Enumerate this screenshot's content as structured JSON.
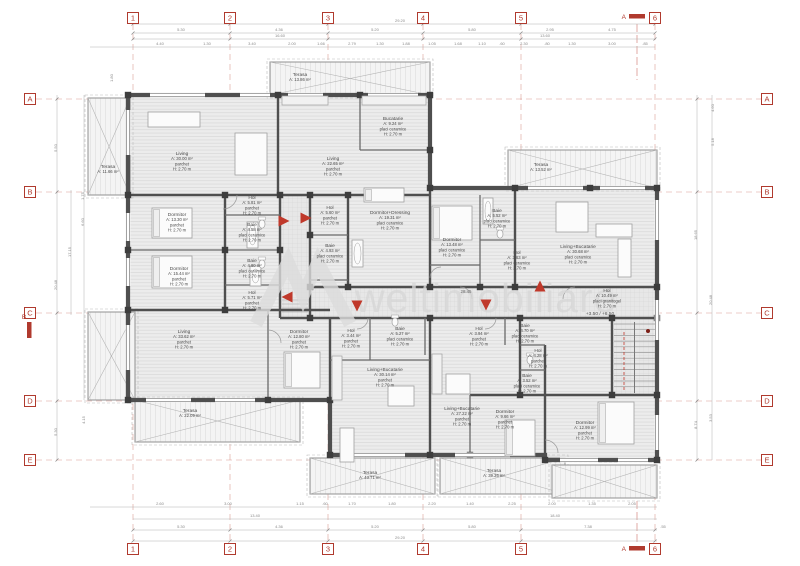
{
  "watermark": {
    "text": "weltimobiliare"
  },
  "colors": {
    "marker_red": "#b03a2e",
    "grid_red": "#c96a5e",
    "wall": "#4f4f4f",
    "partition": "#6a6a6a",
    "dim_text": "#8a8a8a",
    "label_text": "#4a4a4a",
    "watermark_gray": "#d7d7d7",
    "arrow_red": "#c0392b"
  },
  "grid": {
    "columns": [
      {
        "label": "1",
        "x": 133
      },
      {
        "label": "2",
        "x": 230
      },
      {
        "label": "3",
        "x": 328
      },
      {
        "label": "4",
        "x": 423
      },
      {
        "label": "5",
        "x": 521
      },
      {
        "label": "6",
        "x": 655
      }
    ],
    "rows": [
      {
        "label": "A",
        "y": 99
      },
      {
        "label": "B",
        "y": 192
      },
      {
        "label": "C",
        "y": 313
      },
      {
        "label": "D",
        "y": 401
      },
      {
        "label": "E",
        "y": 460
      }
    ],
    "sections": {
      "top_label": "A",
      "bottom_label": "A",
      "left_label": "B"
    }
  },
  "corridor": {
    "length_label": "28.45",
    "level_label": "+3.50 / +6.50"
  },
  "rooms": [
    {
      "kind": "room",
      "name": "Living",
      "area": "A: 30.00 m²",
      "finish": "parchet",
      "height": "H: 2.70 m",
      "x": 182,
      "y": 155
    },
    {
      "kind": "room",
      "name": "Living",
      "area": "A: 22.65 m²",
      "finish": "parchet",
      "height": "H: 2.70 m",
      "x": 333,
      "y": 160
    },
    {
      "kind": "room",
      "name": "Bucatarie",
      "area": "A: 9.24 m²",
      "finish": "placi ceramice",
      "height": "H: 2.70 m",
      "x": 393,
      "y": 120
    },
    {
      "kind": "terrace",
      "name": "Terasa",
      "area": "A: 13.86 m²",
      "x": 300,
      "y": 76
    },
    {
      "kind": "terrace",
      "name": "Terasa",
      "area": "A: 11.66 m²",
      "x": 108,
      "y": 168
    },
    {
      "kind": "terrace",
      "name": "Terasa",
      "area": "A: 13.52 m²",
      "x": 541,
      "y": 166
    },
    {
      "kind": "room",
      "name": "Living+Bucatarie",
      "area": "A: 30.68 m²",
      "finish": "placi ceramice",
      "height": "H: 2.70 m",
      "x": 578,
      "y": 248
    },
    {
      "kind": "room",
      "name": "Dormitor",
      "area": "A: 13.48 m²",
      "finish": "placi ceramice",
      "height": "H: 2.70 m",
      "x": 452,
      "y": 241
    },
    {
      "kind": "room",
      "name": "Baie",
      "area": "A: 5.52 m²",
      "finish": "placi ceramice",
      "height": "H: 2.70 m",
      "x": 497,
      "y": 212
    },
    {
      "kind": "room",
      "name": "Hol",
      "area": "A: 3.63 m²",
      "finish": "placi ceramice",
      "height": "H: 2.70 m",
      "x": 517,
      "y": 254
    },
    {
      "kind": "room",
      "name": "Dormitor+Dressing",
      "area": "A: 19.31 m²",
      "finish": "placi ceramice",
      "height": "H: 2.70 m",
      "x": 390,
      "y": 214
    },
    {
      "kind": "room",
      "name": "Hol",
      "area": "A: 5.60 m²",
      "finish": "parchet",
      "height": "H: 2.70 m",
      "x": 330,
      "y": 209
    },
    {
      "kind": "room",
      "name": "Baie",
      "area": "A: 4.93 m²",
      "finish": "placi ceramice",
      "height": "H: 2.70 m",
      "x": 330,
      "y": 247
    },
    {
      "kind": "room",
      "name": "Hol",
      "area": "A: 5.81 m²",
      "finish": "parchet",
      "height": "H: 2.70 m",
      "x": 252,
      "y": 199
    },
    {
      "kind": "room",
      "name": "Baie",
      "area": "A: 4.58 m²",
      "finish": "placi ceramice",
      "height": "H: 2.70 m",
      "x": 252,
      "y": 226
    },
    {
      "kind": "room",
      "name": "Baie",
      "area": "A: 4.80 m²",
      "finish": "placi ceramice",
      "height": "H: 2.70 m",
      "x": 252,
      "y": 262
    },
    {
      "kind": "room",
      "name": "Hol",
      "area": "A: 5.71 m²",
      "finish": "parchet",
      "height": "H: 2.70 m",
      "x": 252,
      "y": 294
    },
    {
      "kind": "room",
      "name": "Dormitor",
      "area": "A: 13.30 m²",
      "finish": "parchet",
      "height": "H: 2.70 m",
      "x": 177,
      "y": 216
    },
    {
      "kind": "room",
      "name": "Dormitor",
      "area": "A: 15.44 m²",
      "finish": "parchet",
      "height": "H: 2.70 m",
      "x": 179,
      "y": 270
    },
    {
      "kind": "room",
      "name": "Hol",
      "area": "A: 10.49 m²",
      "finish": "placi granitogel",
      "height": "H: 2.70 m",
      "x": 607,
      "y": 292
    },
    {
      "kind": "room",
      "name": "Living",
      "area": "A: 33.62 m²",
      "finish": "parchet",
      "height": "H: 2.70 m",
      "x": 184,
      "y": 333
    },
    {
      "kind": "room",
      "name": "Dormitor",
      "area": "A: 12.80 m²",
      "finish": "parchet",
      "height": "H: 2.70 m",
      "x": 299,
      "y": 333
    },
    {
      "kind": "terrace",
      "name": "Terasa",
      "area": "A: 22.09 m²",
      "x": 190,
      "y": 412
    },
    {
      "kind": "room",
      "name": "Hol",
      "area": "A: 3.44 m²",
      "finish": "parchet",
      "height": "H: 2.70 m",
      "x": 351,
      "y": 332
    },
    {
      "kind": "room",
      "name": "Baie",
      "area": "A: 5.27 m²",
      "finish": "placi ceramice",
      "height": "H: 2.70 m",
      "x": 400,
      "y": 330
    },
    {
      "kind": "room",
      "name": "Living+Bucatarie",
      "area": "A: 30.14 m²",
      "finish": "parchet",
      "height": "H: 2.70 m",
      "x": 385,
      "y": 371
    },
    {
      "kind": "room",
      "name": "Hol",
      "area": "A: 3.94 m²",
      "finish": "parchet",
      "height": "H: 2.70 m",
      "x": 479,
      "y": 330
    },
    {
      "kind": "room",
      "name": "Living+Bucatarie",
      "area": "A: 27.22 m²",
      "finish": "parchet",
      "height": "H: 2.70 m",
      "x": 462,
      "y": 410
    },
    {
      "kind": "room",
      "name": "Baie",
      "area": "A: 4.70 m²",
      "finish": "placi ceramice",
      "height": "H: 2.70 m",
      "x": 525,
      "y": 327
    },
    {
      "kind": "room",
      "name": "Hol",
      "area": "A: 4.28 m²",
      "finish": "parchet",
      "height": "H: 2.70 m",
      "x": 538,
      "y": 352
    },
    {
      "kind": "room",
      "name": "Baie",
      "area": "A: 3.52 m²",
      "finish": "placi ceramice",
      "height": "H: 2.70 m",
      "x": 527,
      "y": 377
    },
    {
      "kind": "room",
      "name": "Dormitor",
      "area": "A: 9.66 m²",
      "finish": "parchet",
      "height": "H: 2.70 m",
      "x": 505,
      "y": 413
    },
    {
      "kind": "room",
      "name": "Dormitor",
      "area": "A: 12.99 m²",
      "finish": "parchet",
      "height": "H: 2.70 m",
      "x": 585,
      "y": 424
    },
    {
      "kind": "terrace",
      "name": "Terasa",
      "area": "A: 43.71 m²",
      "x": 370,
      "y": 474
    },
    {
      "kind": "terrace",
      "name": "Terasa",
      "area": "A: 39.26 m²",
      "x": 494,
      "y": 472
    }
  ],
  "dimensions": {
    "top_overall": {
      "t": "29.20",
      "x": 400,
      "y": 22
    },
    "top_segments": [
      {
        "t": "5.30",
        "x": 181,
        "y": 31
      },
      {
        "t": "4.36",
        "x": 279,
        "y": 31
      },
      {
        "t": "5.20",
        "x": 375,
        "y": 31
      },
      {
        "t": "5.80",
        "x": 472,
        "y": 31
      },
      {
        "t": "2.95",
        "x": 550,
        "y": 31
      },
      {
        "t": "4.75",
        "x": 612,
        "y": 31
      }
    ],
    "top_subtotals": [
      {
        "t": "16.60",
        "x": 280,
        "y": 37
      },
      {
        "t": "13.60",
        "x": 545,
        "y": 37
      }
    ],
    "top_details": [
      {
        "t": "4.40",
        "x": 160
      },
      {
        "t": "1.30",
        "x": 207
      },
      {
        "t": "3.40",
        "x": 252
      },
      {
        "t": "2.00",
        "x": 292
      },
      {
        "t": "1.66",
        "x": 321
      },
      {
        "t": "2.79",
        "x": 352
      },
      {
        "t": "1.30",
        "x": 380
      },
      {
        "t": "1.88",
        "x": 406
      },
      {
        "t": "1.05",
        "x": 432
      },
      {
        "t": "1.68",
        "x": 458
      },
      {
        "t": "1.10",
        "x": 482
      },
      {
        "t": ".60",
        "x": 502
      },
      {
        "t": "2.30",
        "x": 524
      },
      {
        "t": ".80",
        "x": 547
      },
      {
        "t": "1.30",
        "x": 572
      },
      {
        "t": "3.00",
        "x": 612
      },
      {
        "t": ".85",
        "x": 645
      }
    ],
    "bottom_details": [
      {
        "t": "2.60",
        "x": 160
      },
      {
        "t": "3.00",
        "x": 228
      },
      {
        "t": "1.15",
        "x": 300
      },
      {
        "t": ".60",
        "x": 325
      },
      {
        "t": "1.70",
        "x": 352
      },
      {
        "t": "1.80",
        "x": 392
      },
      {
        "t": "2.20",
        "x": 432
      },
      {
        "t": "1.40",
        "x": 470
      },
      {
        "t": "2.25",
        "x": 512
      },
      {
        "t": "2.00",
        "x": 552
      },
      {
        "t": "1.35",
        "x": 592
      },
      {
        "t": "2.05",
        "x": 632
      }
    ],
    "bottom_subtotals": [
      {
        "t": "13.40",
        "x": 255,
        "y": 517
      },
      {
        "t": "18.40",
        "x": 555,
        "y": 517
      }
    ],
    "bottom_segments": [
      {
        "t": "5.30",
        "x": 181,
        "y": 528
      },
      {
        "t": "4.36",
        "x": 279,
        "y": 528
      },
      {
        "t": "5.20",
        "x": 375,
        "y": 528
      },
      {
        "t": "5.80",
        "x": 472,
        "y": 528
      },
      {
        "t": "7.38",
        "x": 588,
        "y": 528
      },
      {
        "t": ".55",
        "x": 663,
        "y": 528
      }
    ],
    "bottom_overall": {
      "t": "29.20",
      "x": 400,
      "y": 539
    },
    "left": [
      {
        "t": "1.80",
        "x": 113,
        "y": 78
      },
      {
        "t": "5.50",
        "x": 57,
        "y": 148
      },
      {
        "t": "1.75",
        "x": 84,
        "y": 196
      },
      {
        "t": "6.60",
        "x": 84,
        "y": 222
      },
      {
        "t": "17.15",
        "x": 71,
        "y": 252
      },
      {
        "t": "20.48",
        "x": 57,
        "y": 285
      },
      {
        "t": "4.15",
        "x": 85,
        "y": 420
      },
      {
        "t": "5.30",
        "x": 57,
        "y": 432
      }
    ],
    "right": [
      {
        "t": "4.60",
        "x": 714,
        "y": 108
      },
      {
        "t": "5.18",
        "x": 714,
        "y": 142
      },
      {
        "t": "18.65",
        "x": 697,
        "y": 235
      },
      {
        "t": "20.48",
        "x": 712,
        "y": 300
      },
      {
        "t": "3.53",
        "x": 712,
        "y": 418
      },
      {
        "t": "8.74",
        "x": 697,
        "y": 425
      }
    ]
  }
}
